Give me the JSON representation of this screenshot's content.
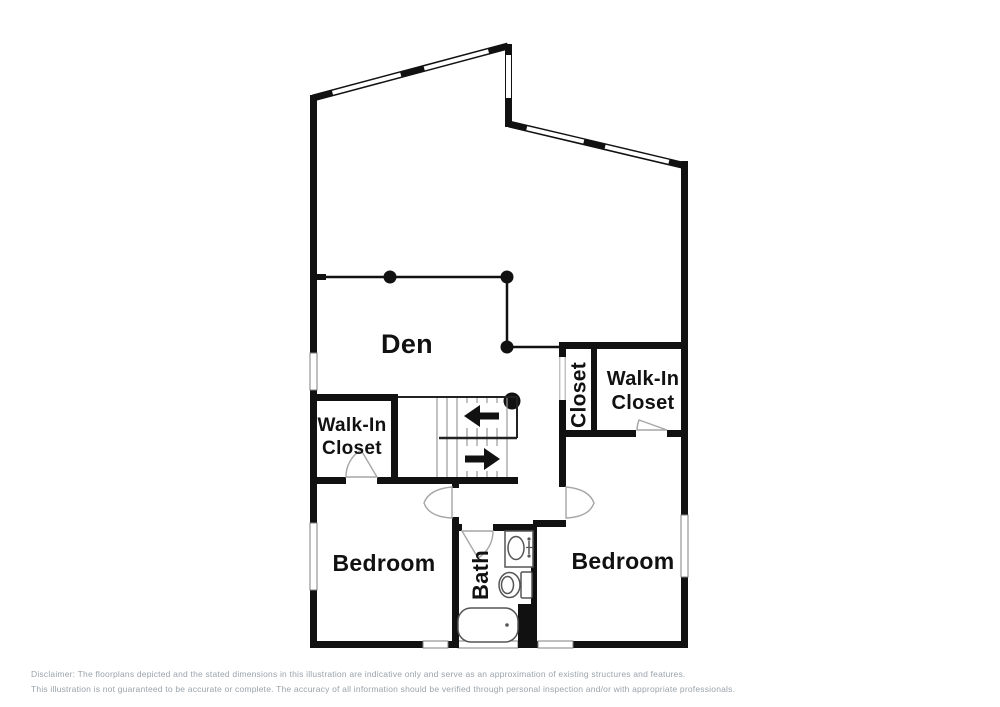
{
  "floorplan": {
    "rooms": {
      "den": {
        "label": "Den"
      },
      "walk_in_closet_left": {
        "label_line1": "Walk-In",
        "label_line2": "Closet"
      },
      "closet": {
        "label": "Closet"
      },
      "walk_in_closet_right": {
        "label_line1": "Walk-In",
        "label_line2": "Closet"
      },
      "bedroom_left": {
        "label": "Bedroom"
      },
      "bath": {
        "label": "Bath"
      },
      "bedroom_right": {
        "label": "Bedroom"
      }
    },
    "stairs": {
      "up_arrow_direction": "left",
      "down_arrow_direction": "right"
    },
    "colors": {
      "wall": "#111111",
      "window_outline": "#808080",
      "door_arc": "#a6a6a6",
      "stair_tread": "#999999",
      "fixture_outline": "#555555",
      "label_text": "#111111",
      "disclaimer_text": "#9aa3ab",
      "background": "#ffffff"
    }
  },
  "disclaimer": {
    "line1": "Disclaimer: The floorplans depicted and the stated dimensions in this illustration are indicative only and serve as an approximation of existing structures and features.",
    "line2": "This illustration is not guaranteed to be accurate or complete. The accuracy of all information should be verified through personal inspection and/or with appropriate professionals."
  }
}
